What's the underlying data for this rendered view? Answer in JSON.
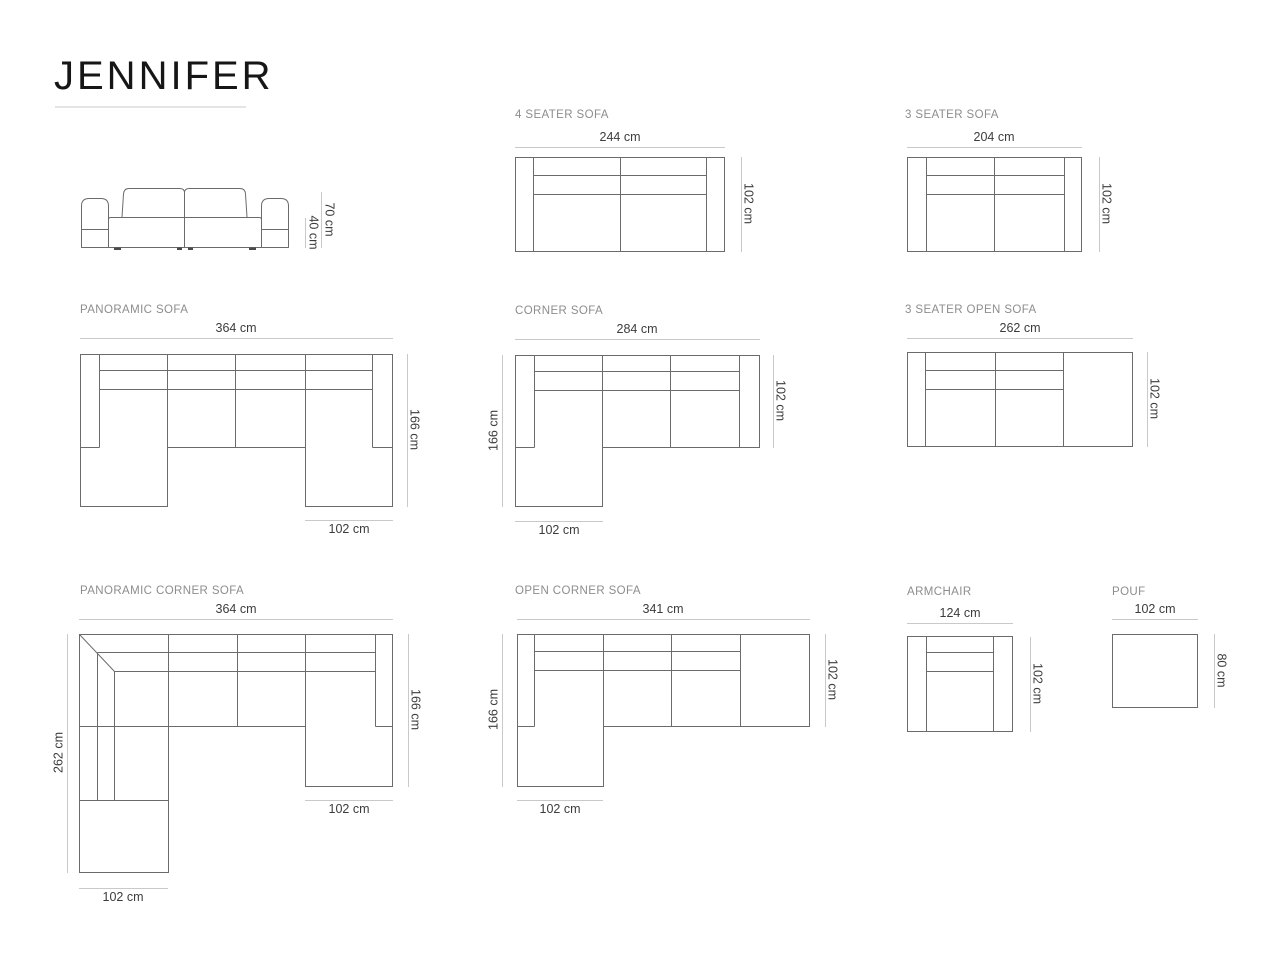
{
  "page": {
    "title": "JENNIFER"
  },
  "colors": {
    "drawing_line": "#6b6b6b",
    "dimension_line": "#c9c9c9",
    "dimension_text": "#3c3c3c",
    "section_text": "#8d8d8d",
    "title_text": "#161616"
  },
  "products": {
    "front_view": {
      "overall_height": "70 cm",
      "seat_height": "40 cm"
    },
    "four_seater": {
      "label": "4 SEATER SOFA",
      "width": "244 cm",
      "depth": "102 cm"
    },
    "three_seater": {
      "label": "3 SEATER SOFA",
      "width": "204 cm",
      "depth": "102 cm"
    },
    "panoramic": {
      "label": "PANORAMIC SOFA",
      "width": "364 cm",
      "depth": "166 cm",
      "chaise_width": "102 cm"
    },
    "corner": {
      "label": "CORNER SOFA",
      "width": "284 cm",
      "depth": "166 cm",
      "body_depth": "102 cm",
      "chaise_width": "102 cm"
    },
    "three_seater_open": {
      "label": "3 SEATER OPEN SOFA",
      "width": "262 cm",
      "depth": "102 cm"
    },
    "panoramic_corner": {
      "label": "PANORAMIC CORNER SOFA",
      "width": "364 cm",
      "left_depth": "262 cm",
      "right_depth": "166 cm",
      "right_chaise_width": "102 cm",
      "bottom_width": "102 cm"
    },
    "open_corner": {
      "label": "OPEN CORNER SOFA",
      "width": "341 cm",
      "depth": "166 cm",
      "body_depth": "102 cm",
      "chaise_width": "102 cm"
    },
    "armchair": {
      "label": "ARMCHAIR",
      "width": "124 cm",
      "depth": "102 cm"
    },
    "pouf": {
      "label": "POUF",
      "width": "102 cm",
      "depth": "80 cm"
    }
  }
}
